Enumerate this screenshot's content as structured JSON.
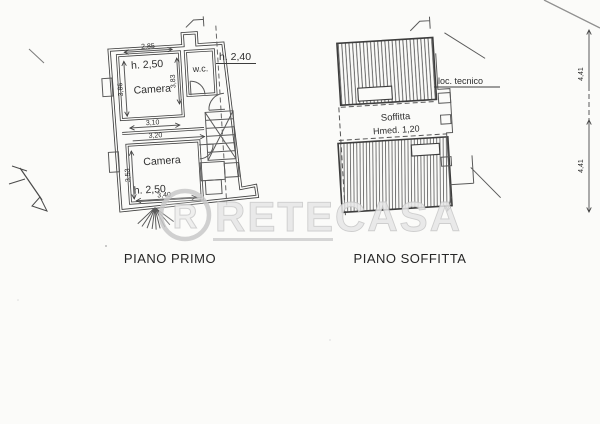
{
  "titles": {
    "primo": "PIANO PRIMO",
    "soffitta": "PIANO SOFFITTA"
  },
  "primo": {
    "dim_top_width": "2,85",
    "room_top_height": "h. 2,50",
    "room_top_name": "Camera",
    "dim_left_top": "3,86",
    "dim_right_top": "3,83",
    "wc_name": "w.c.",
    "wc_height": "h. 2,40",
    "dim_mid_1": "3,10",
    "dim_mid_2": "3,20",
    "room_bottom_name": "Camera",
    "room_bottom_height": "h. 2,50",
    "dim_bottom_width": "3,40",
    "dim_left_bottom": "3,53"
  },
  "soffitta": {
    "room_name": "Soffitta",
    "height_label": "Hmed. 1,20",
    "loc_tecnico_label": "loc. tecnico"
  },
  "right_dimension": {
    "upper": "4,41",
    "lower": "4,41"
  },
  "watermark": {
    "brand": "RETECASA",
    "logo_letter": "R"
  },
  "colors": {
    "ink": "#3d3d3d",
    "paper": "#fbfbf9",
    "watermark": "#d9d9d9"
  }
}
